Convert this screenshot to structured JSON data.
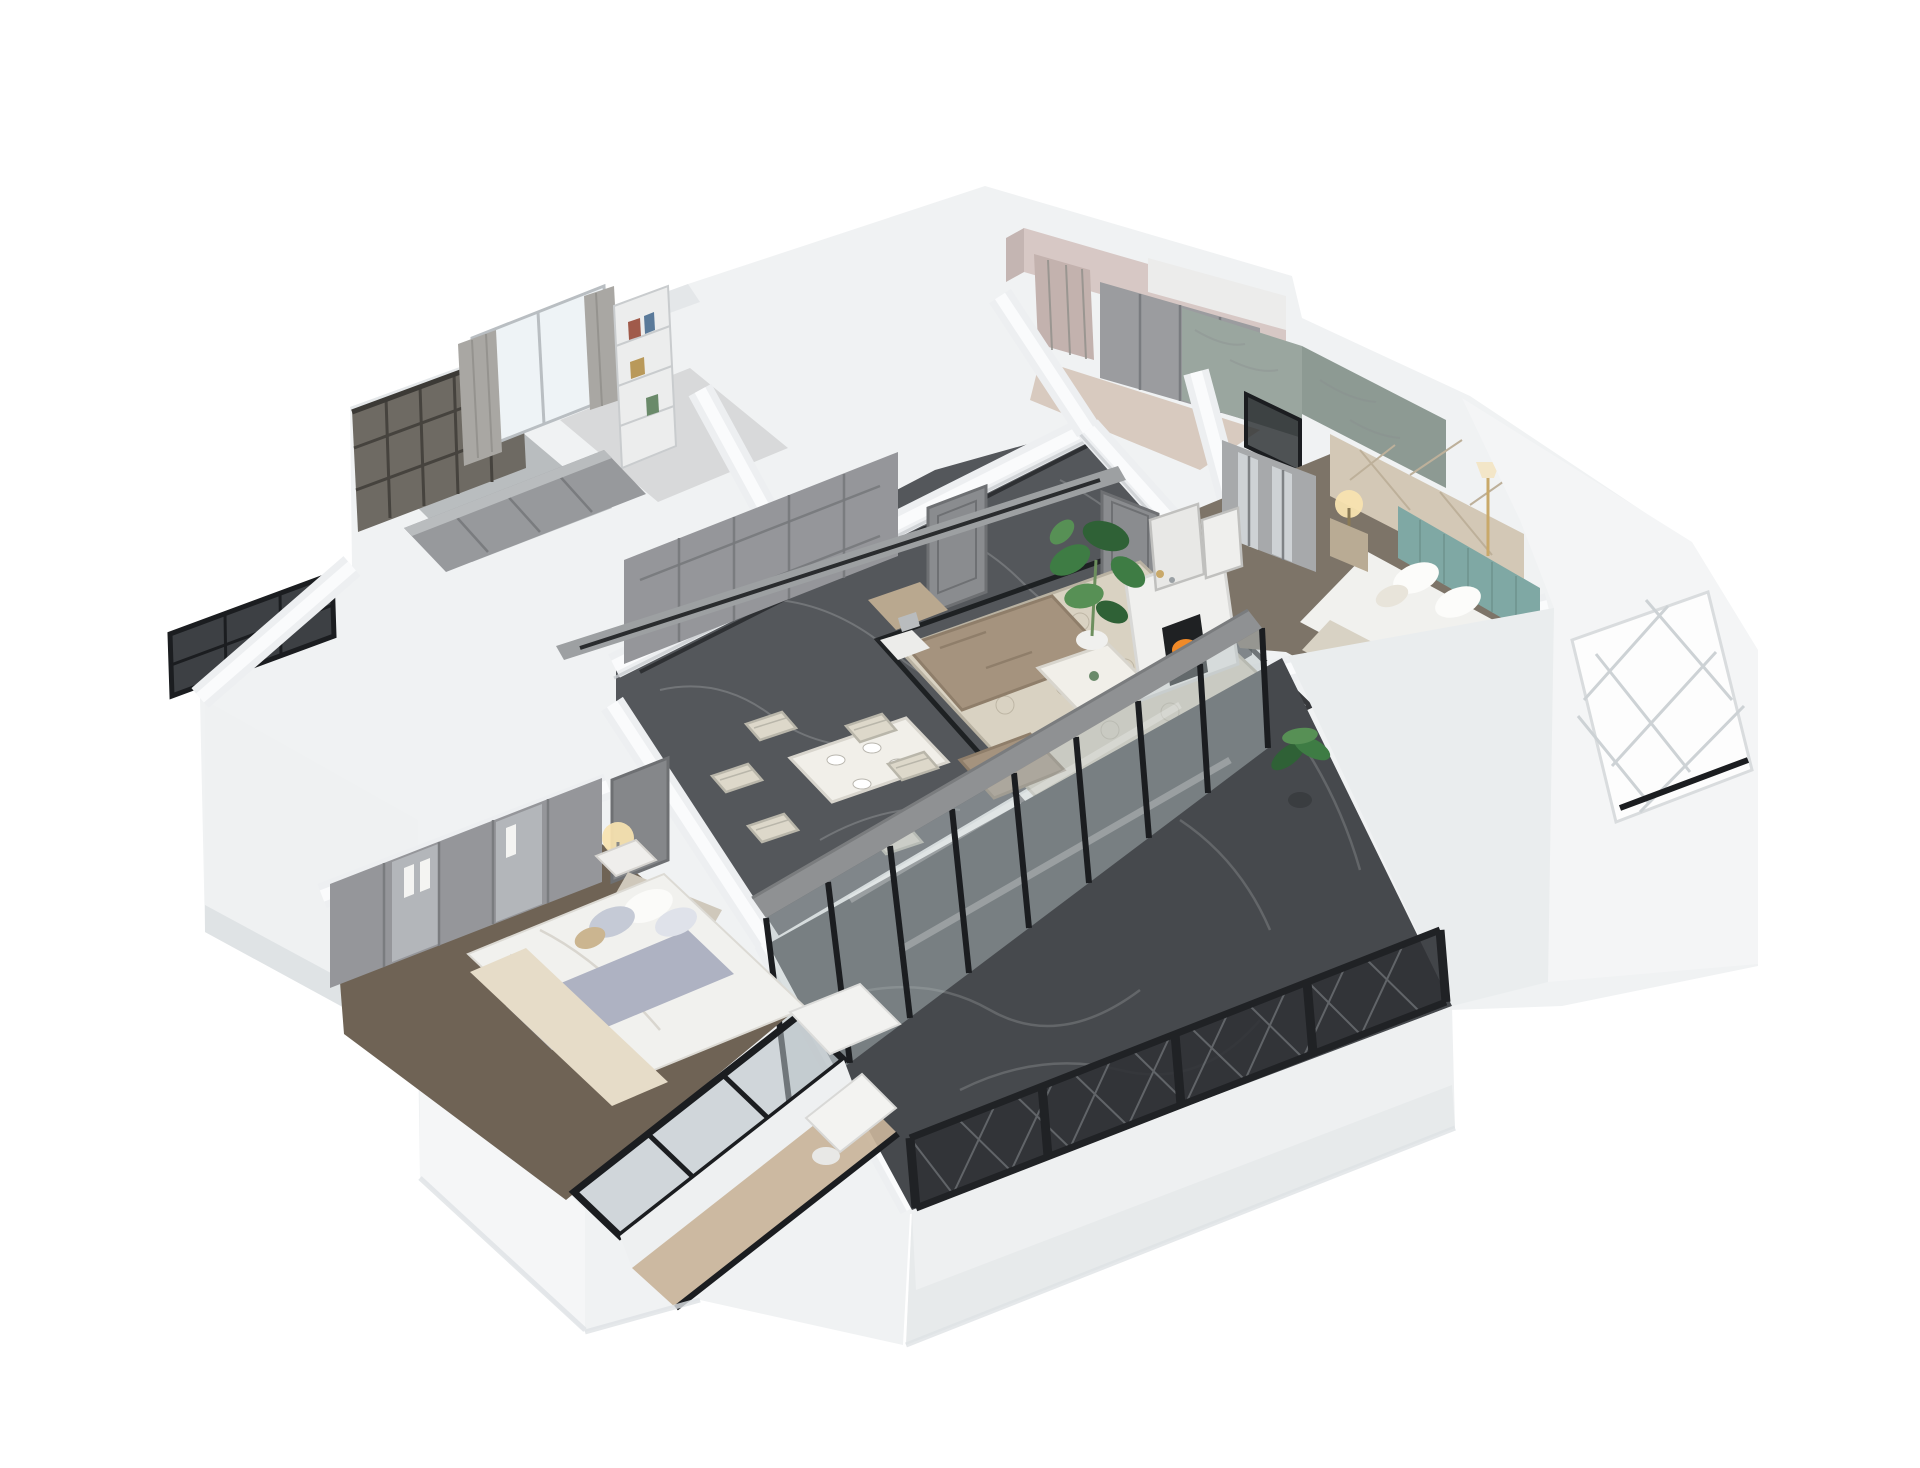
{
  "scene": {
    "title": "3D cutaway dollhouse rendering of an apartment floor plan",
    "view": "axonometric aerial view, rotated diagonally on a plain white background",
    "background_color": "#ffffff",
    "visible_text": "none"
  },
  "palette": {
    "background": "#ffffff",
    "wall_white": "#f3f5f6",
    "wall_shade": "#e2e6e8",
    "wall_dark": "#cfd4d7",
    "floor_marble": "#54575b",
    "floor_balcony": "#46494d",
    "inlay_black": "#17191c",
    "glass_tint": "#b6c0c4",
    "frame_black": "#1b1d20",
    "railing_black": "#303236",
    "cabinet_gray": "#95969a",
    "door_gray": "#8a8c8f",
    "curtain_gray": "#a9a7a3",
    "rug_cream": "#d9d2c2",
    "rug_pattern": "#b3ab99",
    "sofa_taupe": "#a5937e",
    "table_white": "#f1efe9",
    "chair_cream": "#ddd8ca",
    "fire_orange": "#f08a28",
    "fire_glow": "#ffcf6e",
    "plant_green": "#3e7c44",
    "plant_green_light": "#579055",
    "lamp_glow": "#f8e3b0",
    "gold": "#c9a96a",
    "headboard_teal": "#7fa8a4",
    "panel_beige": "#d3c8b6",
    "wall_pink": "#d7c8c5",
    "bath_marble": "#9aa69f",
    "carpet_brown": "#6f6355",
    "wood_floor": "#c9b49a",
    "bed_white": "#f1f1ee",
    "blanket_gray": "#aeb2c2",
    "throw_cream": "#e6dcc8",
    "lattice_screen": "#6e6a63"
  },
  "rooms": [
    {
      "id": "living-room",
      "label": "Living room",
      "features": [
        "dark marble floor with black inlay border",
        "cream rug with quatrefoil pattern",
        "taupe sectional sofa",
        "two taupe armchairs",
        "white coffee table with vase",
        "white fireplace with burning fire",
        "two leaning art frames on mantel",
        "monstera plant in white pot",
        "gray track-light beam",
        "side table with lamp"
      ]
    },
    {
      "id": "dining-area",
      "label": "Dining area",
      "features": [
        "white dining table",
        "six cream X-back chairs",
        "white place settings"
      ]
    },
    {
      "id": "hallway",
      "label": "Hallway",
      "features": [
        "gray built-in paneled wardrobes",
        "two gray panel doors",
        "black floor inlay strip"
      ]
    },
    {
      "id": "study",
      "label": "Study",
      "features": [
        "window with gray curtains",
        "white bookshelf with books",
        "gray cabinet desk run"
      ]
    },
    {
      "id": "utility-balcony",
      "label": "Utility balcony",
      "features": [
        "dark wood lattice screen",
        "gray storage cabinet",
        "dark lattice window on outer wall"
      ]
    },
    {
      "id": "second-bedroom",
      "label": "Second bedroom",
      "features": [
        "pink walls",
        "mauve curtains",
        "gray wardrobe",
        "white upper cabinets"
      ]
    },
    {
      "id": "bathroom",
      "label": "Bathroom",
      "features": [
        "green-gray marble walls",
        "black framed glass shower"
      ]
    },
    {
      "id": "master-bedroom",
      "label": "Master bedroom",
      "features": [
        "bed with white duvet",
        "gray-lavender blanket",
        "cream throw",
        "stacked pillows",
        "glass-front wardrobes with hanging clothes",
        "nightstand with lit lamp",
        "brown carpet",
        "black framed windows",
        "wood-floor desk nook with white vanity"
      ]
    },
    {
      "id": "teal-bedroom",
      "label": "Bedroom with teal bed",
      "features": [
        "teal channel-tufted headboard",
        "beige geometric accent wall",
        "white bedding",
        "nightstand with lit lamp",
        "gold floor lamp",
        "mirrored wardrobe",
        "white bay window volume with diamond lattice grille"
      ]
    },
    {
      "id": "main-balcony",
      "label": "Main balcony",
      "features": [
        "dark marble floor",
        "black diamond-mesh railing with posts",
        "full-height black framed glass sliding doors",
        "potted palm plant",
        "white parapet plinth"
      ]
    }
  ]
}
